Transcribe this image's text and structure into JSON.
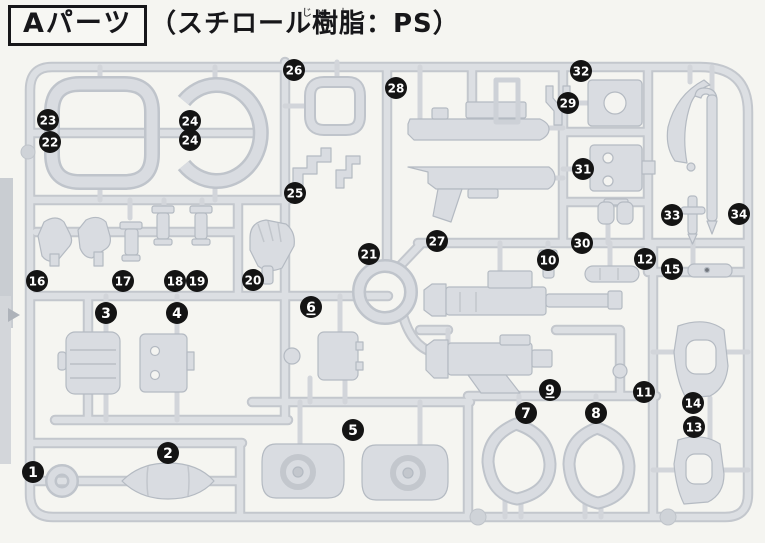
{
  "header": {
    "part_label": "Aパーツ",
    "material": "（スチロール樹脂：PS）",
    "furigana": "じゅ し"
  },
  "diagram": {
    "kind": "injection-molded runner (sprue) part-location diagram",
    "runner_letter": "A",
    "badge_color": "#141414",
    "badge_text_color": "#ffffff",
    "sprue_color": "#d9dce1",
    "badges": [
      {
        "n": "1",
        "x": 33,
        "y": 472
      },
      {
        "n": "2",
        "x": 168,
        "y": 453
      },
      {
        "n": "3",
        "x": 106,
        "y": 313
      },
      {
        "n": "4",
        "x": 177,
        "y": 313
      },
      {
        "n": "5",
        "x": 353,
        "y": 430
      },
      {
        "n": "6",
        "x": 311,
        "y": 307,
        "underline": true
      },
      {
        "n": "7",
        "x": 526,
        "y": 413
      },
      {
        "n": "8",
        "x": 596,
        "y": 413
      },
      {
        "n": "9",
        "x": 550,
        "y": 390,
        "underline": true
      },
      {
        "n": "10",
        "x": 548,
        "y": 260
      },
      {
        "n": "11",
        "x": 644,
        "y": 392
      },
      {
        "n": "12",
        "x": 645,
        "y": 259
      },
      {
        "n": "13",
        "x": 694,
        "y": 427
      },
      {
        "n": "14",
        "x": 693,
        "y": 403
      },
      {
        "n": "15",
        "x": 672,
        "y": 269
      },
      {
        "n": "16",
        "x": 37,
        "y": 281
      },
      {
        "n": "17",
        "x": 123,
        "y": 281
      },
      {
        "n": "18",
        "x": 175,
        "y": 281
      },
      {
        "n": "19",
        "x": 197,
        "y": 281
      },
      {
        "n": "20",
        "x": 253,
        "y": 280
      },
      {
        "n": "21",
        "x": 369,
        "y": 254
      },
      {
        "n": "22",
        "x": 50,
        "y": 142
      },
      {
        "n": "23",
        "x": 48,
        "y": 120
      },
      {
        "n": "24",
        "x": 190,
        "y": 121
      },
      {
        "n": "24",
        "x": 190,
        "y": 140
      },
      {
        "n": "25",
        "x": 295,
        "y": 193
      },
      {
        "n": "26",
        "x": 294,
        "y": 70
      },
      {
        "n": "27",
        "x": 437,
        "y": 241
      },
      {
        "n": "28",
        "x": 396,
        "y": 88
      },
      {
        "n": "29",
        "x": 568,
        "y": 103
      },
      {
        "n": "30",
        "x": 582,
        "y": 243
      },
      {
        "n": "31",
        "x": 583,
        "y": 169
      },
      {
        "n": "32",
        "x": 581,
        "y": 71
      },
      {
        "n": "33",
        "x": 672,
        "y": 215
      },
      {
        "n": "34",
        "x": 739,
        "y": 214
      }
    ]
  }
}
